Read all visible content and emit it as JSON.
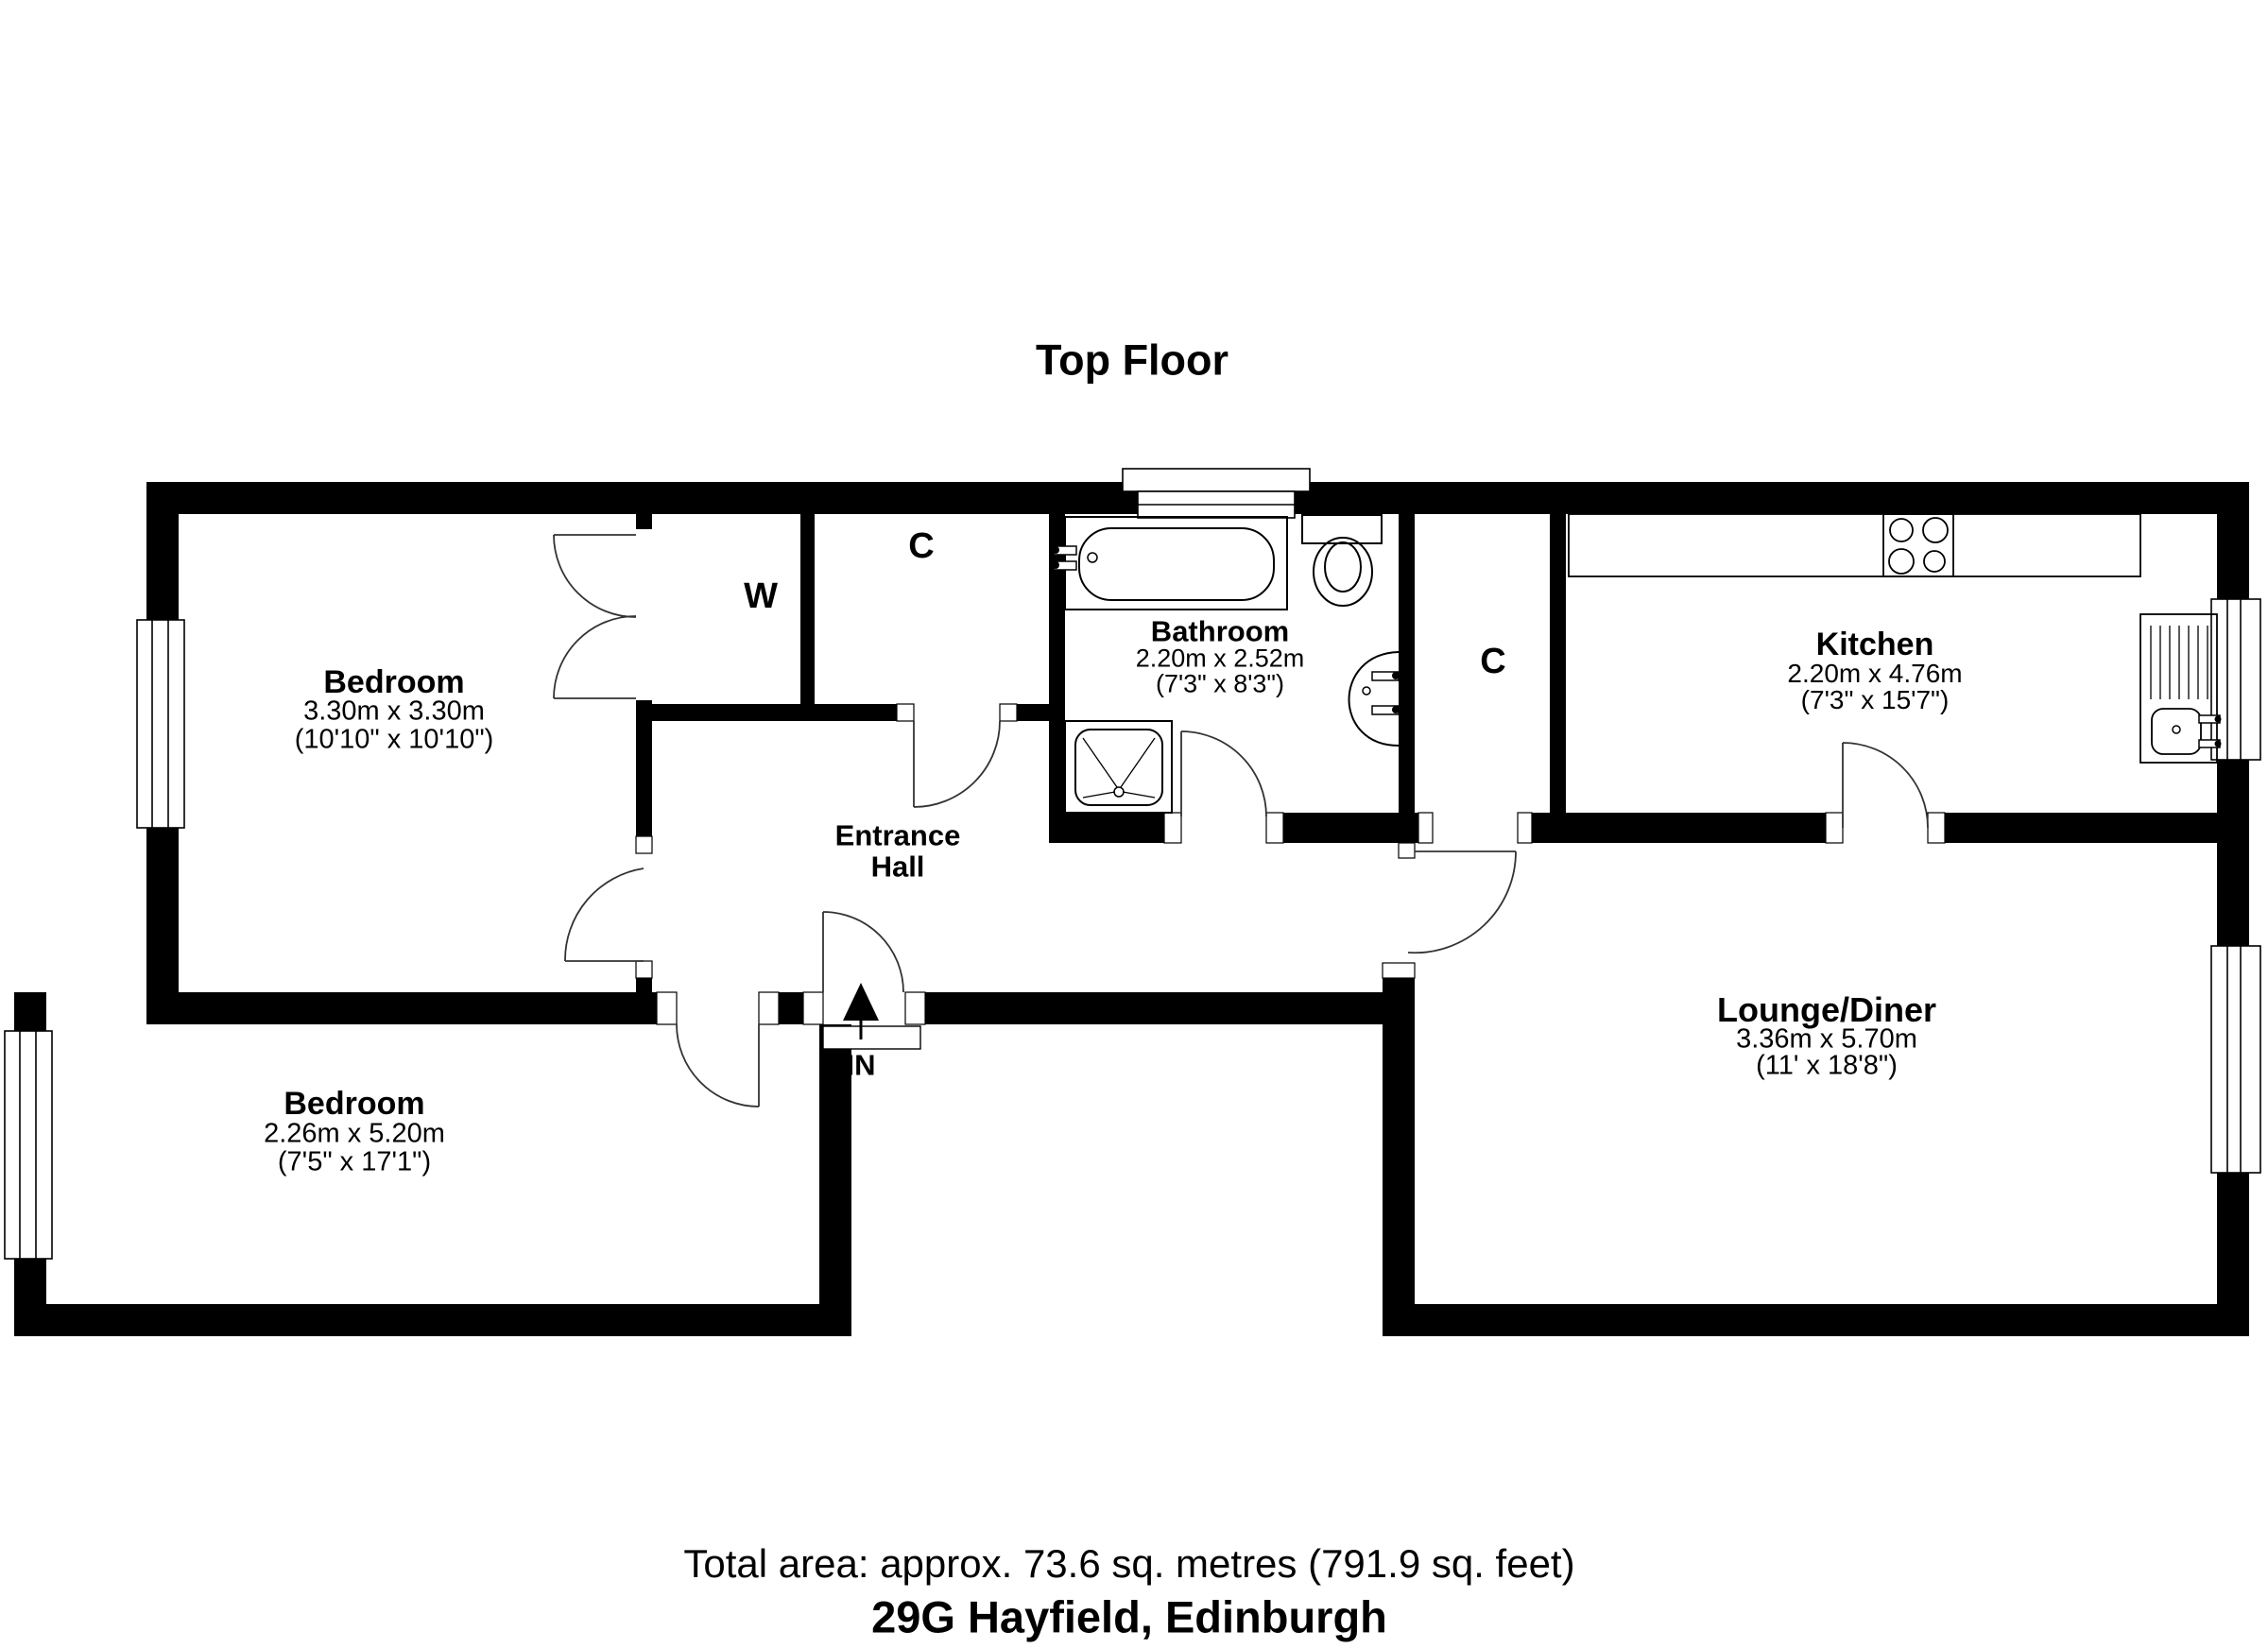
{
  "title": "Top Floor",
  "rooms": {
    "bedroom1": {
      "name": "Bedroom",
      "metric": "3.30m x 3.30m",
      "imperial": "(10'10\" x 10'10\")"
    },
    "bedroom2": {
      "name": "Bedroom",
      "metric": "2.26m x 5.20m",
      "imperial": "(7'5\" x 17'1\")"
    },
    "bathroom": {
      "name": "Bathroom",
      "metric": "2.20m x 2.52m",
      "imperial": "(7'3\" x 8'3\")"
    },
    "kitchen": {
      "name": "Kitchen",
      "metric": "2.20m x 4.76m",
      "imperial": "(7'3\" x 15'7\")"
    },
    "lounge": {
      "name": "Lounge/Diner",
      "metric": "3.36m x 5.70m",
      "imperial": "(11' x 18'8\")"
    },
    "hall": {
      "line1": "Entrance",
      "line2": "Hall"
    }
  },
  "labels": {
    "wardrobe": "W",
    "closet1": "C",
    "closet2": "C",
    "entrance_in": "IN"
  },
  "footer": {
    "total_area": "Total area: approx. 73.6 sq. metres (791.9 sq. feet)",
    "address": "29G Hayfield, Edinburgh"
  },
  "colors": {
    "wall": "#000000",
    "background": "#ffffff",
    "door_line": "#333333"
  }
}
